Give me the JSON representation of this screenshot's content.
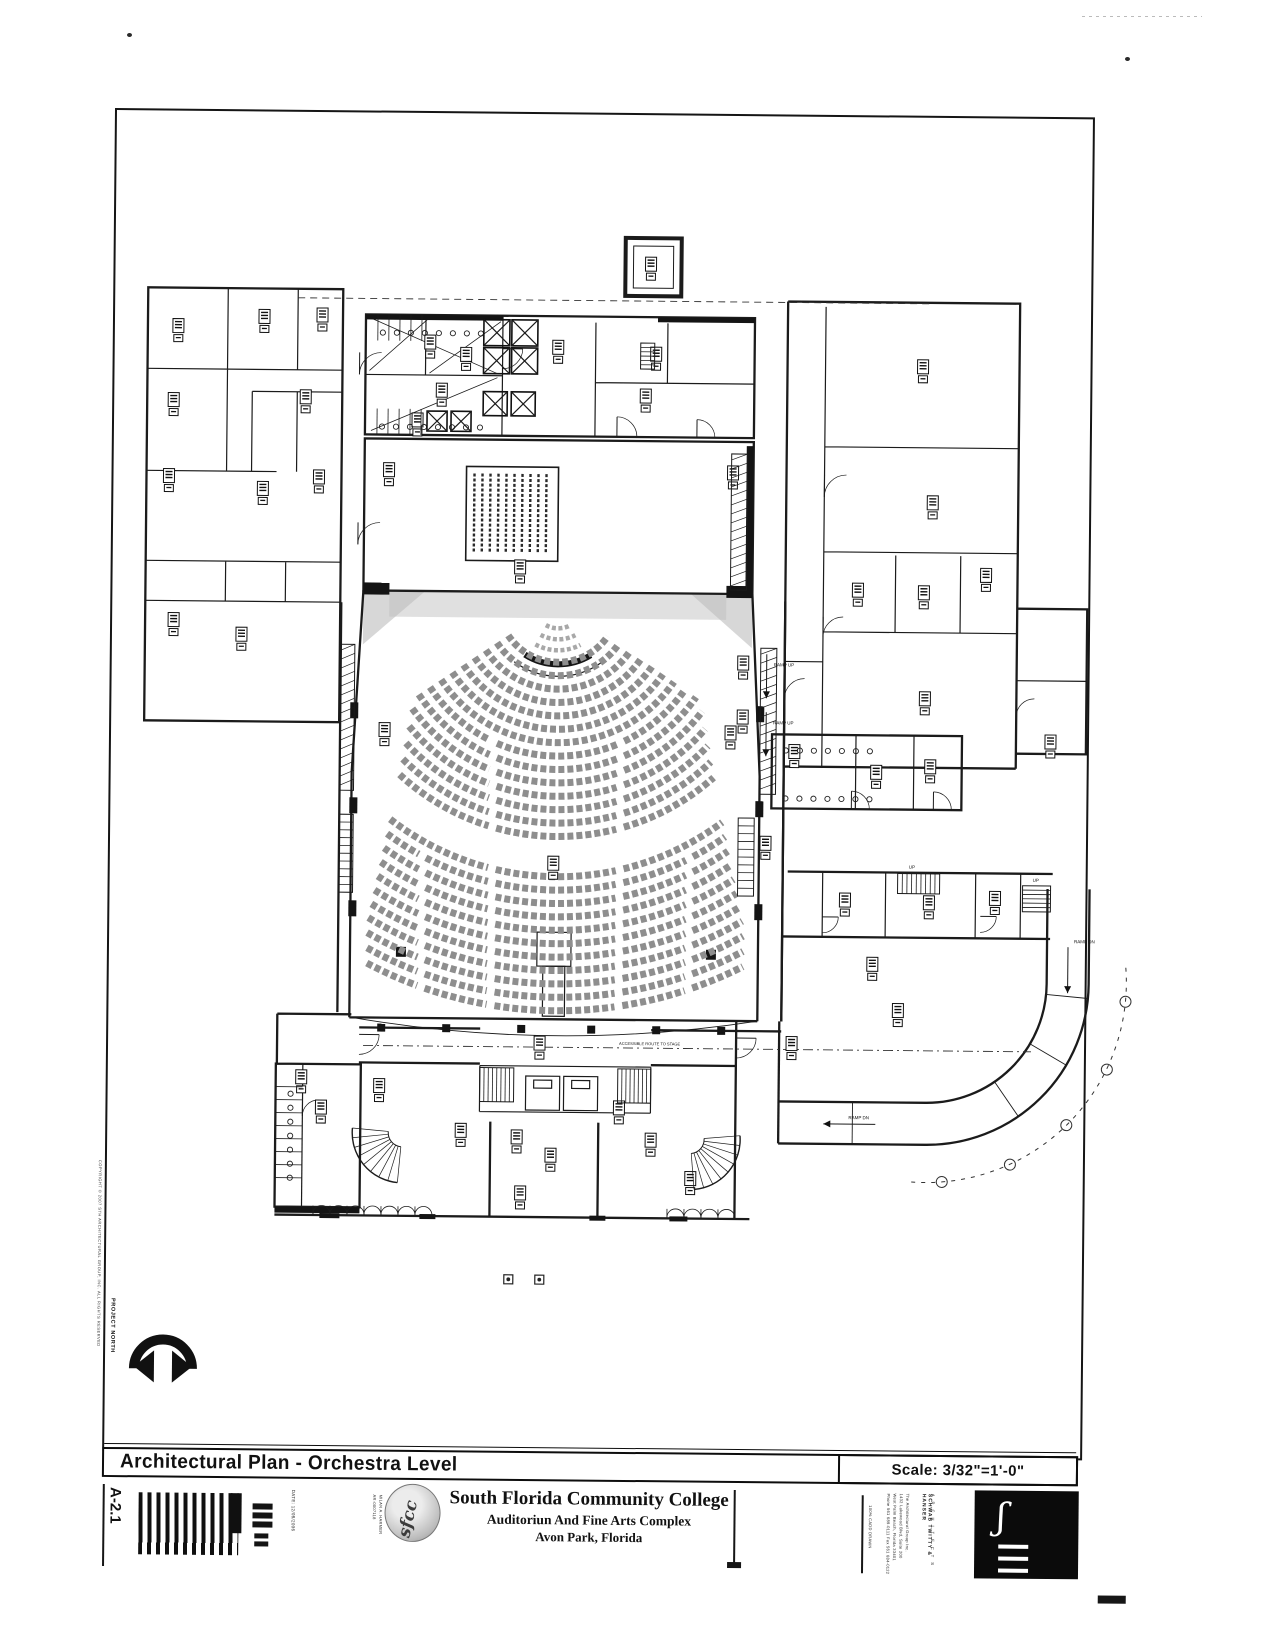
{
  "title_bar": {
    "title": "Architectural Plan - Orchestra Level",
    "scale": "Scale: 3/32\"=1'-0\""
  },
  "title_block": {
    "sheet_number": "A-2.1",
    "date": "DATE: 12/08/2006",
    "architect_reg_name": "MILAN A. HARMER",
    "architect_reg_no": "AR-0007118",
    "client_logo_text": "sfcc",
    "client_name": "South Florida Community College",
    "project_name": "Auditoriun And Fine Arts Complex",
    "project_location": "Avon Park, Florida",
    "firm_name": "SCHWAB TWITTY & HANSER",
    "firm_subtitle": "A R C H I T E C T S",
    "firm_address_lines": [
      "The Architectural Group Inc.",
      "1432 Lakewood Blvd, Suite 200",
      "West Palm Beach, Florida 33401",
      "Phone 561 689-0111  Fax 561 684-0122"
    ],
    "cadd_note": "100% CADD DRAWN"
  },
  "margins": {
    "copyright": "COPYRIGHT © 2007 STH ARCHITECTURAL GROUP, INC. ALL RIGHTS RESERVED",
    "north_label": "PROJECT NORTH"
  },
  "plan_labels": {
    "ramp_up": "RAMP UP",
    "ramp_dn": "RAMP DN",
    "up": "UP",
    "accessible_route": "ACCESSIBLE ROUTE TO STAGE"
  }
}
